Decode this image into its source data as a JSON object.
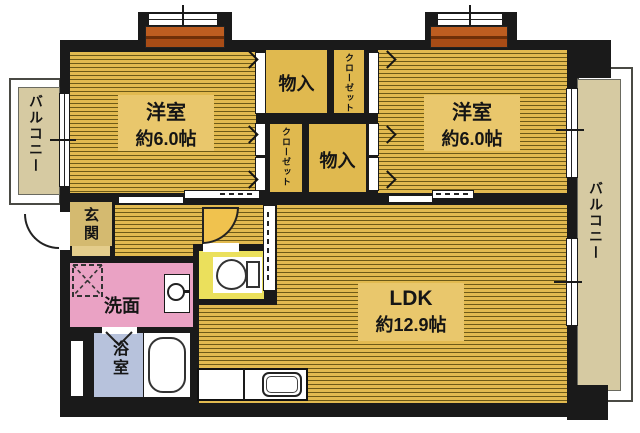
{
  "floorplan": {
    "rooms": [
      {
        "id": "bedroom_left",
        "name": "洋室",
        "area": "約6.0帖"
      },
      {
        "id": "bedroom_right",
        "name": "洋室",
        "area": "約6.0帖"
      },
      {
        "id": "ldk",
        "name": "LDK",
        "area": "約12.9帖"
      }
    ],
    "labels": {
      "storage": "物入",
      "closet": "クローゼット",
      "balcony": "バルコニー",
      "entrance": "玄関",
      "washroom": "洗面",
      "bathroom": "浴室"
    },
    "colors": {
      "wall": "#1a1a1a",
      "wood": "#e2ba50",
      "wood_line": "#6d5a17",
      "label_patch": "#e9c76c",
      "storage": "#e0b94f",
      "balcony": "#d6caa2",
      "entrance": "#d4ba70",
      "entrance_step": "#e4cd8c",
      "washroom": "#eaa2c4",
      "bathroom": "#b7c2dc",
      "toilet": "#ebe05c",
      "door_arc": "#f0c24e",
      "window_sill": "#a84c16"
    }
  }
}
